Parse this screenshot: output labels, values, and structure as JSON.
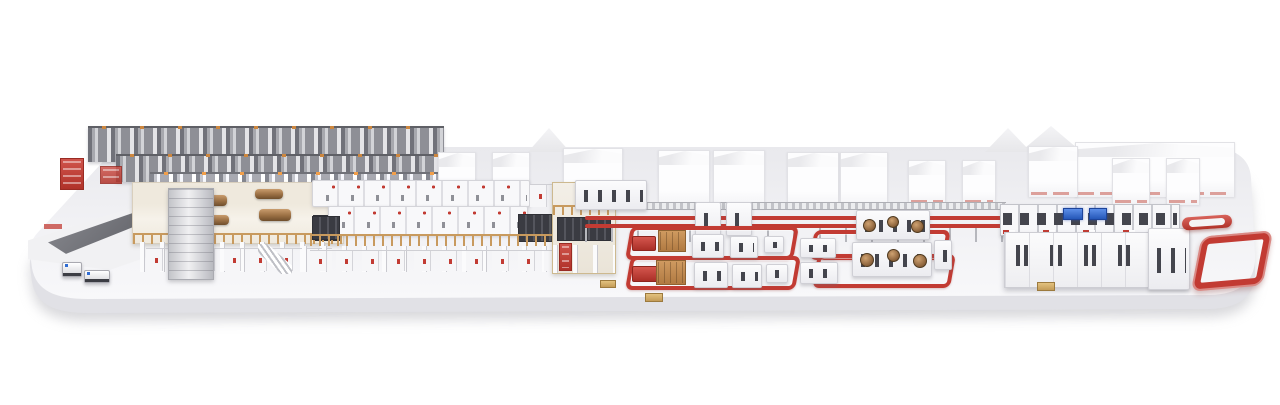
{
  "scene": {
    "name": "corrugated-board-production-line-panorama",
    "style": "photorealistic-3d-render",
    "background": "#ffffff",
    "platform": "rounded-white-display-plinth-with-soft-shadow",
    "sections": [
      {
        "name": "paper-reel-storage-rack",
        "area": "back-left"
      },
      {
        "name": "reel-infeed-platform-with-agvs",
        "area": "far-left"
      },
      {
        "name": "corrugator-wet-end-splicers-with-paper-rolls",
        "area": "left"
      },
      {
        "name": "elevated-corrugator-line-on-columns",
        "area": "center-left"
      },
      {
        "name": "dry-end-transfer-tower",
        "area": "center"
      },
      {
        "name": "overhead-red-conveyor-bridge",
        "area": "center"
      },
      {
        "name": "converting-lines-group-1-with-red-floor-loops",
        "area": "center"
      },
      {
        "name": "converting-lines-group-2-flexo-printers",
        "area": "center-right"
      },
      {
        "name": "background-factory-building-row",
        "area": "background"
      },
      {
        "name": "palletizing-logistics-center-with-blue-screens",
        "area": "right"
      },
      {
        "name": "red-racetrack-conveyor-loop",
        "area": "far-right"
      }
    ]
  },
  "colors": {
    "red": "#c23b33",
    "red_dark": "#992b23",
    "red_light": "#d8635b",
    "orange": "#cd873f",
    "tan_rail": "#c89a5e",
    "brown_roll": "#9a6f43",
    "machine_white": "#f8f8fa",
    "outline": "#d2d2d8",
    "window_dark": "#44454d",
    "rack_gray": "#8e8f96",
    "screen_blue": "#2f6cd3",
    "platform_top": "#f2f2f5",
    "platform_front": "#e1e1e6",
    "shadow": "#bcbcc2",
    "deck_beige": "#efe9dd"
  },
  "counts": {
    "agvs": 2,
    "converting_floor_loops": 4,
    "background_towers": 11,
    "blue_screens": 2
  }
}
